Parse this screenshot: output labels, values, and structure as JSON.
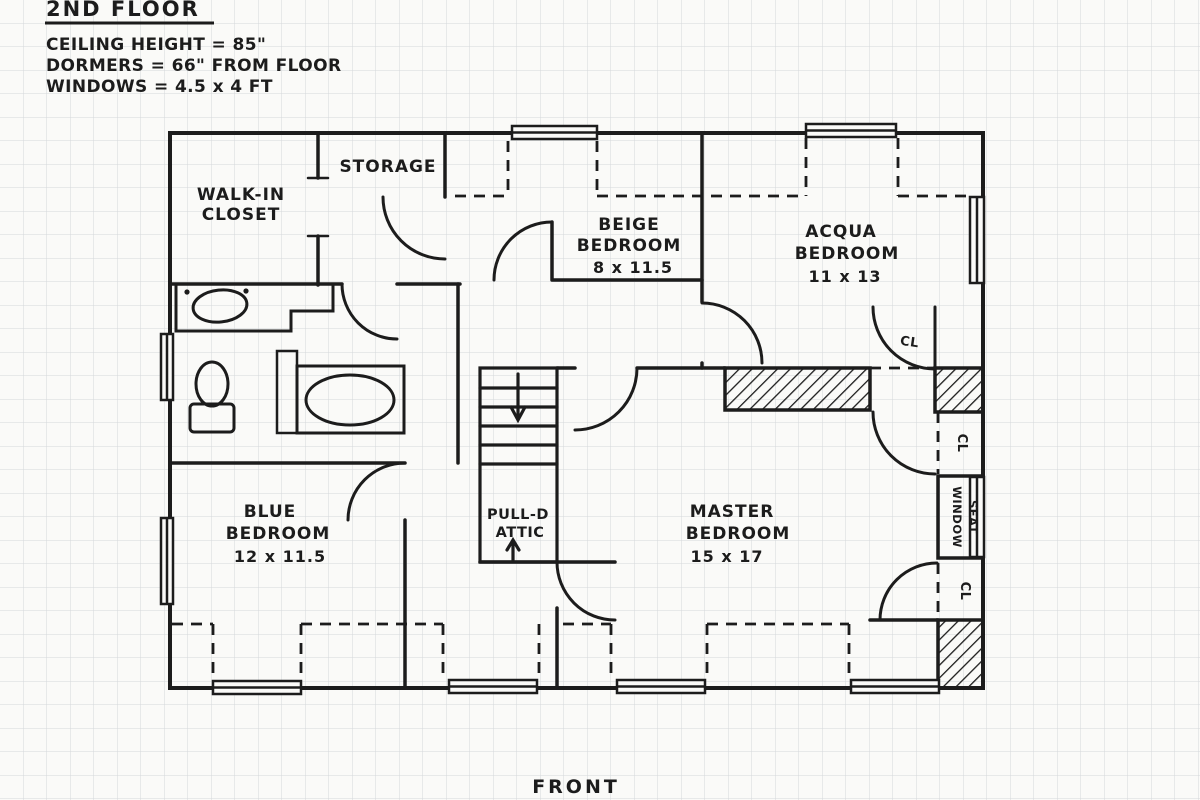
{
  "header": {
    "title": "2ND FLOOR",
    "notes": [
      "CEILING HEIGHT = 85\"",
      "DORMERS = 66\" FROM FLOOR",
      "WINDOWS = 4.5 x 4 FT"
    ]
  },
  "rooms": {
    "walkin": {
      "lines": [
        "WALK-IN",
        "CLOSET"
      ]
    },
    "storage": {
      "label": "STORAGE"
    },
    "beige": {
      "lines": [
        "BEIGE",
        "BEDROOM",
        "8 x 11.5"
      ]
    },
    "acqua": {
      "lines": [
        "ACQUA",
        "BEDROOM",
        "11 x 13"
      ]
    },
    "blue": {
      "lines": [
        "BLUE",
        "BEDROOM",
        "12 x 11.5"
      ]
    },
    "master": {
      "lines": [
        "MASTER",
        "BEDROOM",
        "15 x 17"
      ]
    },
    "attic": {
      "lines": [
        "PULL-D",
        "ATTIC"
      ]
    },
    "window_seat": {
      "lines": [
        "WINDOW",
        "SEAT"
      ]
    },
    "closet_abbr": "CL"
  },
  "footer": {
    "front_label": "FRONT"
  },
  "colors": {
    "ink": "#1c1c1c",
    "paper": "#fafaf8",
    "grid": "#d4d8da"
  }
}
